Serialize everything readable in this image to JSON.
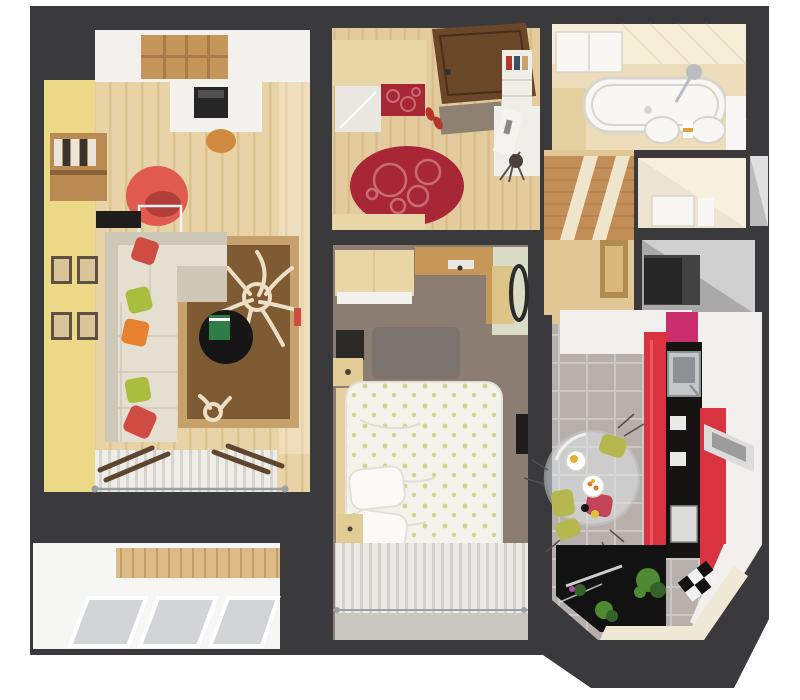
{
  "meta": {
    "title": "3D top-down apartment floor plan render",
    "canvas": {
      "width": 800,
      "height": 700
    }
  },
  "rooms": [
    {
      "id": "living-room",
      "label": "living-room",
      "furniture": [
        "corner-sofa",
        "throw-pillows",
        "floral-rug",
        "round-coffee-table",
        "red-armchair",
        "glass-side-table",
        "bookshelf",
        "wall-picture-frames",
        "desk-with-printer",
        "cube-shelf",
        "radiator-window"
      ]
    },
    {
      "id": "balcony",
      "label": "balcony",
      "furniture": [
        "glazed-window-panes",
        "wood-paneling"
      ]
    },
    {
      "id": "hallway",
      "label": "entrance-hall",
      "furniture": [
        "entrance-door",
        "wardrobe-with-mirror",
        "red-bench",
        "oval-red-rug",
        "doormat",
        "shoes",
        "shelf-unit",
        "coat-stand"
      ]
    },
    {
      "id": "corridor",
      "label": "corridor",
      "furniture": [
        "wood-slat-ceiling-panel",
        "picture-frame"
      ]
    },
    {
      "id": "bathroom",
      "label": "bathroom",
      "furniture": [
        "bathtub",
        "shower-set",
        "twin-sinks",
        "wall-cabinet",
        "towels"
      ]
    },
    {
      "id": "wc",
      "label": "toilet-room",
      "furniture": [
        "cabinet"
      ]
    },
    {
      "id": "storage",
      "label": "storage-closet",
      "furniture": []
    },
    {
      "id": "bedroom",
      "label": "bedroom",
      "furniture": [
        "double-bed",
        "wardrobe",
        "nightstands",
        "wall-tv",
        "round-wall-mirror",
        "shag-rug",
        "window-curtains"
      ]
    },
    {
      "id": "kitchen",
      "label": "kitchen",
      "furniture": [
        "red-cabinet-run",
        "black-appliance-column",
        "steel-sink",
        "tall-white-cabinet",
        "round-glass-table",
        "chair-cushions",
        "plants",
        "checkered-tiles",
        "bay-window-counter"
      ]
    }
  ],
  "palette": {
    "page": "#ffffff",
    "wall": "#3a393c",
    "livingFloor": "#e8d3a6",
    "livingPlank": "#dbc390",
    "yellowWall": "#ecd987",
    "whiteUnit": "#f3f1ed",
    "woodCube": "#c49659",
    "woodDivider": "#a87c48",
    "printerBody": "#262626",
    "printerTop": "#4f4f4f",
    "stoolOrange": "#d08a3e",
    "bookshelfWood": "#b98a52",
    "spineLight": "#e9e5da",
    "spineDark": "#38332c",
    "shelfEdge": "#8a6238",
    "frameBorder": "#5f5142",
    "framePhoto": "#d9c49a",
    "armchairRed": "#e05a50",
    "armchairShade": "#b23e3a",
    "glassLine": "#eef2f3",
    "tvBlack": "#1f1d1c",
    "sofa": "#e4dfd1",
    "sofaShade": "#cec8b8",
    "pillowRed": "#d04b42",
    "pillowGreen": "#a9bd3e",
    "pillowOrange": "#e6822f",
    "rugBorder": "#c6a16c",
    "rugBrown": "#7f5b33",
    "rugFlower": "#ecdfc5",
    "tableBlack": "#161616",
    "bookGreen": "#2e7d46",
    "radiator": "#efede9",
    "radiatorLine": "#d7d4cd",
    "plankBrown": "#5d452e",
    "rodGray": "#9aa0a4",
    "balconyWhite": "#f6f6f5",
    "balconyWood": "#dcbb86",
    "balconyWoodDark": "#c3a06a",
    "glassPane": "#d2d5d7",
    "hallFloor": "#e4cb9e",
    "hallPlank": "#d7bb8b",
    "doorBrown": "#6b4729",
    "doorEdge": "#4a2f18",
    "wardrobeWood": "#e9d6a6",
    "mirrorSilver": "#e9e7e2",
    "redAccent": "#a82737",
    "redAccentLine": "#c96b77",
    "doormat": "#8c8173",
    "shoeRed": "#b5372c",
    "shelfWhite": "#f0eee9",
    "shelfLine": "#d8d4cc",
    "bookBlue": "#3a4e68",
    "bookTan": "#c9a36a",
    "boardWhite": "#f4f3ef",
    "figureGray": "#8a8a8a",
    "standWire": "#5c564e",
    "knobDark": "#4a423a",
    "handleDark": "#2e2e2e",
    "bathWall": "#f5edd8",
    "bathFloor": "#eddcba",
    "bathTile": "#e3cf9f",
    "fixtureWhite": "#f8f7f4",
    "fixtureEdge": "#d8d5ce",
    "chrome": "#b9bdc1",
    "towelOrange": "#dfa13c",
    "wcWall": "#f6f0dc",
    "wcShade": "#e8decb",
    "nicheGray": "#bcbcbc",
    "nicheLight": "#e0e0e0",
    "closetGray": "#a9a9a9",
    "closetLight": "#cfcfcf",
    "closetDark": "#424242",
    "closetBlack": "#262626",
    "corridorWood": "#c28f58",
    "corridorSlat": "#a9763f",
    "corridorStripe": "#efe5cc",
    "corridorFloor": "#e0c793",
    "picFrame": "#b08d4f",
    "picArt": "#d9b87c",
    "bedFloor": "#8c7d73",
    "sageWall": "#d9dcc6",
    "lintelWood": "#c79758",
    "cabinetWood": "#ddc488",
    "mirrorRing": "#2b2b2b",
    "bedRug": "#7a736e",
    "duvet": "#f4f3eb",
    "duvetGreen": "#ccd78d",
    "duvetFold": "#e0ded3",
    "pillowWhite": "#fbfaf6",
    "pillowEdge": "#e2e0d8",
    "bedRail": "#e6d19e",
    "nightstand": "#e2cc95",
    "tvStand": "#2b2926",
    "curtain": "#eae9e5",
    "curtainStripe": "#d2d1cc",
    "sillGray": "#c9c6bf",
    "kitchenTile": "#b6afab",
    "grout": "#cdc7c3",
    "counterWhite": "#f2f0ed",
    "pinkPanel": "#cb2e6c",
    "cabRed": "#d8333f",
    "cabRedLight": "#ea5761",
    "applianceBlack": "#151413",
    "steel": "#c4c7ca",
    "steelDark": "#8e9194",
    "knobWhite": "#e9e9e7",
    "applianceWhite": "#dcdcda",
    "ventLight": "#dcdcdc",
    "ventDark": "#9c9c9c",
    "glassTable": "#dfe5e8",
    "glassTableEdge": "#c6cbcd",
    "plateWhite": "#ffffff",
    "plateEdge": "#d8d5cf",
    "yolkYellow": "#e6b02c",
    "foodOrange": "#d97c2e",
    "dotBlack": "#141414",
    "dotYellow": "#e2c235",
    "cushionOlive": "#b5b84e",
    "cushionCrimson": "#c24458",
    "chairWire": "#55504a",
    "bayBlack": "#121212",
    "bayStreak": "#eff0f0",
    "plantGreen": "#4f8a33",
    "plantDark": "#35622a",
    "flowerPurple": "#a94fa4",
    "checkerWhite": "#f2f2f2",
    "checkerBlack": "#111111",
    "creamFloor": "#efe8d5"
  }
}
